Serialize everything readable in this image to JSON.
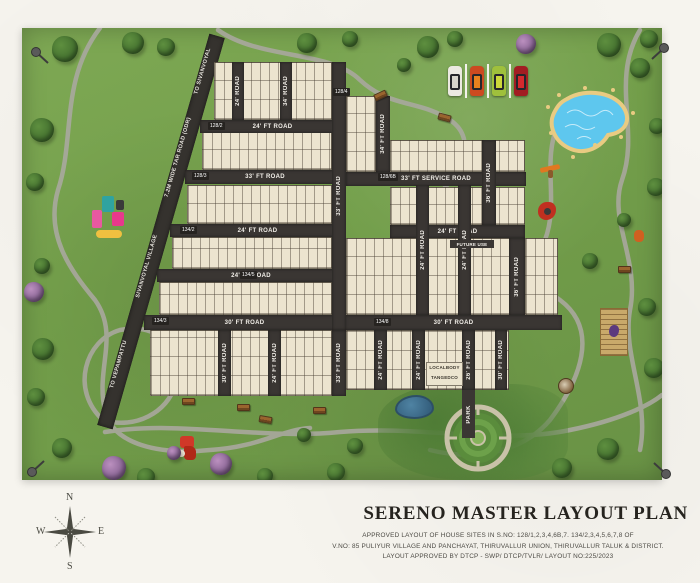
{
  "colors": {
    "paper": "#f6f4ee",
    "field_green": "#74a04b",
    "road_dark": "#3a3633",
    "plot_beige": "#ece4cf",
    "pool_water": "#5ec7ee",
    "pool_sand": "#e9cb82",
    "path_gray": "#a9a89e"
  },
  "map": {
    "road_labels": {
      "r24ft": "24' FT ROAD",
      "r24": "24' ROAD",
      "r30ft": "30' FT ROAD",
      "r33ft": "33' FT ROAD",
      "r33service": "33' FT SERVICE ROAD",
      "r34": "34' ROAD",
      "r34ft": "34' FT ROAD",
      "r36ft": "36' FT ROAD",
      "r26ft": "26' FT ROAD",
      "tar_road": "7.2M WIDE TAR ROAD (ODR)",
      "to_sivanvoyal": "TO SIVANVOYAL",
      "to_vepampattu": "TO VEPAMPATTU",
      "village": "SIVANVOYAL VILLAGE"
    },
    "survey_numbers": [
      "128/2",
      "128/3",
      "128/4",
      "128/6B",
      "134/2",
      "134/5",
      "134/8",
      "134/3"
    ],
    "zone_labels": {
      "future_use": "FUTURE USE",
      "localbody": "LOCALBODY",
      "tangedco": "TANGEDCO",
      "park": "PARK"
    }
  },
  "compass": {
    "north": "N",
    "east": "E",
    "south": "S",
    "west": "W"
  },
  "title_block": {
    "title": "SERENO MASTER LAYOUT PLAN",
    "line1": "APPROVED LAYOUT OF HOUSE SITES IN S.NO: 128/1,2,3,4,6B,7. 134/2,3,4,5,6,7,8 OF",
    "line2": "V.NO: 85 PULIYUR VILLAGE AND PANCHAYAT, THIRUVALLUR UNION, THIRUVALLUR TALUK & DISTRICT.",
    "line3": "LAYOUT APPROVED BY DTCP - SWP/ DTCP/TVLR/ LAYOUT NO:225/2023"
  }
}
